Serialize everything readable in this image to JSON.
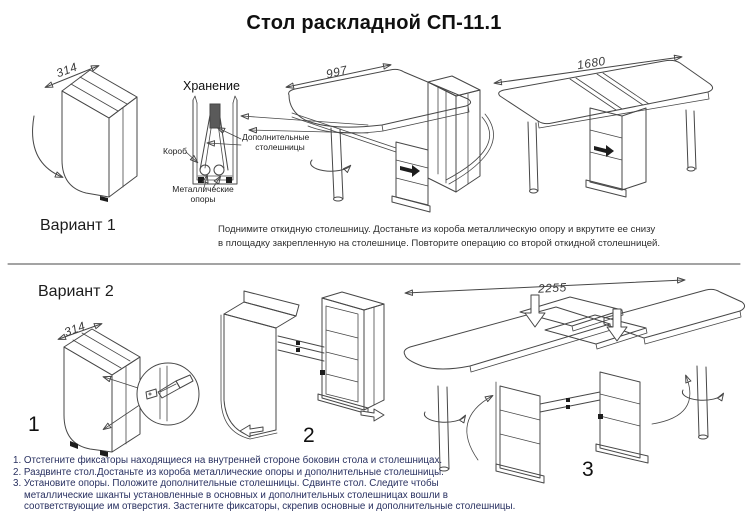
{
  "title": "Стол раскладной СП-11.1",
  "variant1": {
    "label": "Вариант 1",
    "dim_folded": "314",
    "dim_half": "997",
    "dim_full": "1680",
    "storage_title": "Хранение",
    "storage_labels": {
      "box": "Короб",
      "extra_tops_line1": "Дополнительные",
      "extra_tops_line2": "столешницы",
      "supports_line1": "Металлические",
      "supports_line2": "опоры"
    },
    "note_line1": "Поднимите откидную столешницу. Достаньте из короба металлическую опору и вкрутите ее снизу",
    "note_line2": "в площадку закрепленную на столешнице. Повторите операцию со второй откидной столешницей."
  },
  "variant2": {
    "label": "Вариант 2",
    "dim_folded": "314",
    "dim_full": "2255",
    "step1": "1",
    "step2": "2",
    "step3": "3",
    "instructions": [
      "1. Отстегните фиксаторы находящиеся на внутренней стороне боковин стола и столешницах.",
      "2. Раздвинте стол.Достаньте из короба металлические опоры и дополнительные столешницы.",
      "3. Установите опоры. Положите дополнительные столешницы. Сдвинте стол. Следите чтобы",
      "металлические шканты установленные в основных и дополнительных столешницах вошли в",
      "соответствующие им отверстия. Застегните фиксаторы, скрепив основные и дополнительные столешницы."
    ]
  },
  "colors": {
    "line_art": "#474747",
    "instructions_text": "#283060"
  }
}
